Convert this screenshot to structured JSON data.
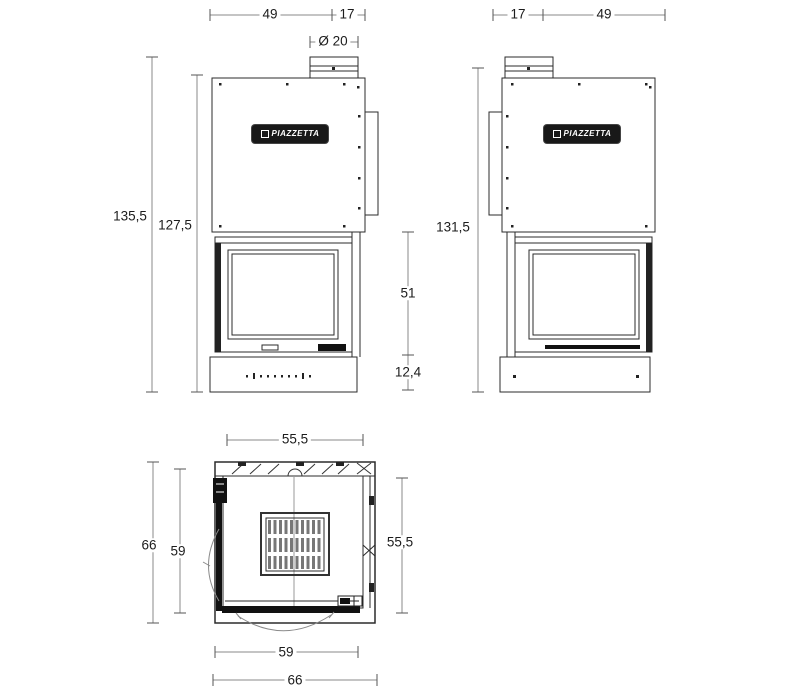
{
  "brand_logo": "PIAZZETTA",
  "front_view": {
    "dim_top_width": "49",
    "dim_top_flue_offset": "17",
    "dim_flue_diameter": "Ø 20",
    "dim_total_height": "135,5",
    "dim_body_height": "127,5",
    "dim_firebox_height": "51",
    "dim_base_height": "12,4"
  },
  "side_view": {
    "dim_top_flue_offset": "17",
    "dim_top_width": "49",
    "dim_total_height": "131,5"
  },
  "plan_view": {
    "dim_top_width": "55,5",
    "dim_depth_outer_left": "66",
    "dim_depth_inner_left": "59",
    "dim_depth_right": "55,5",
    "dim_width_inner_bottom": "59",
    "dim_width_outer_bottom": "66"
  }
}
